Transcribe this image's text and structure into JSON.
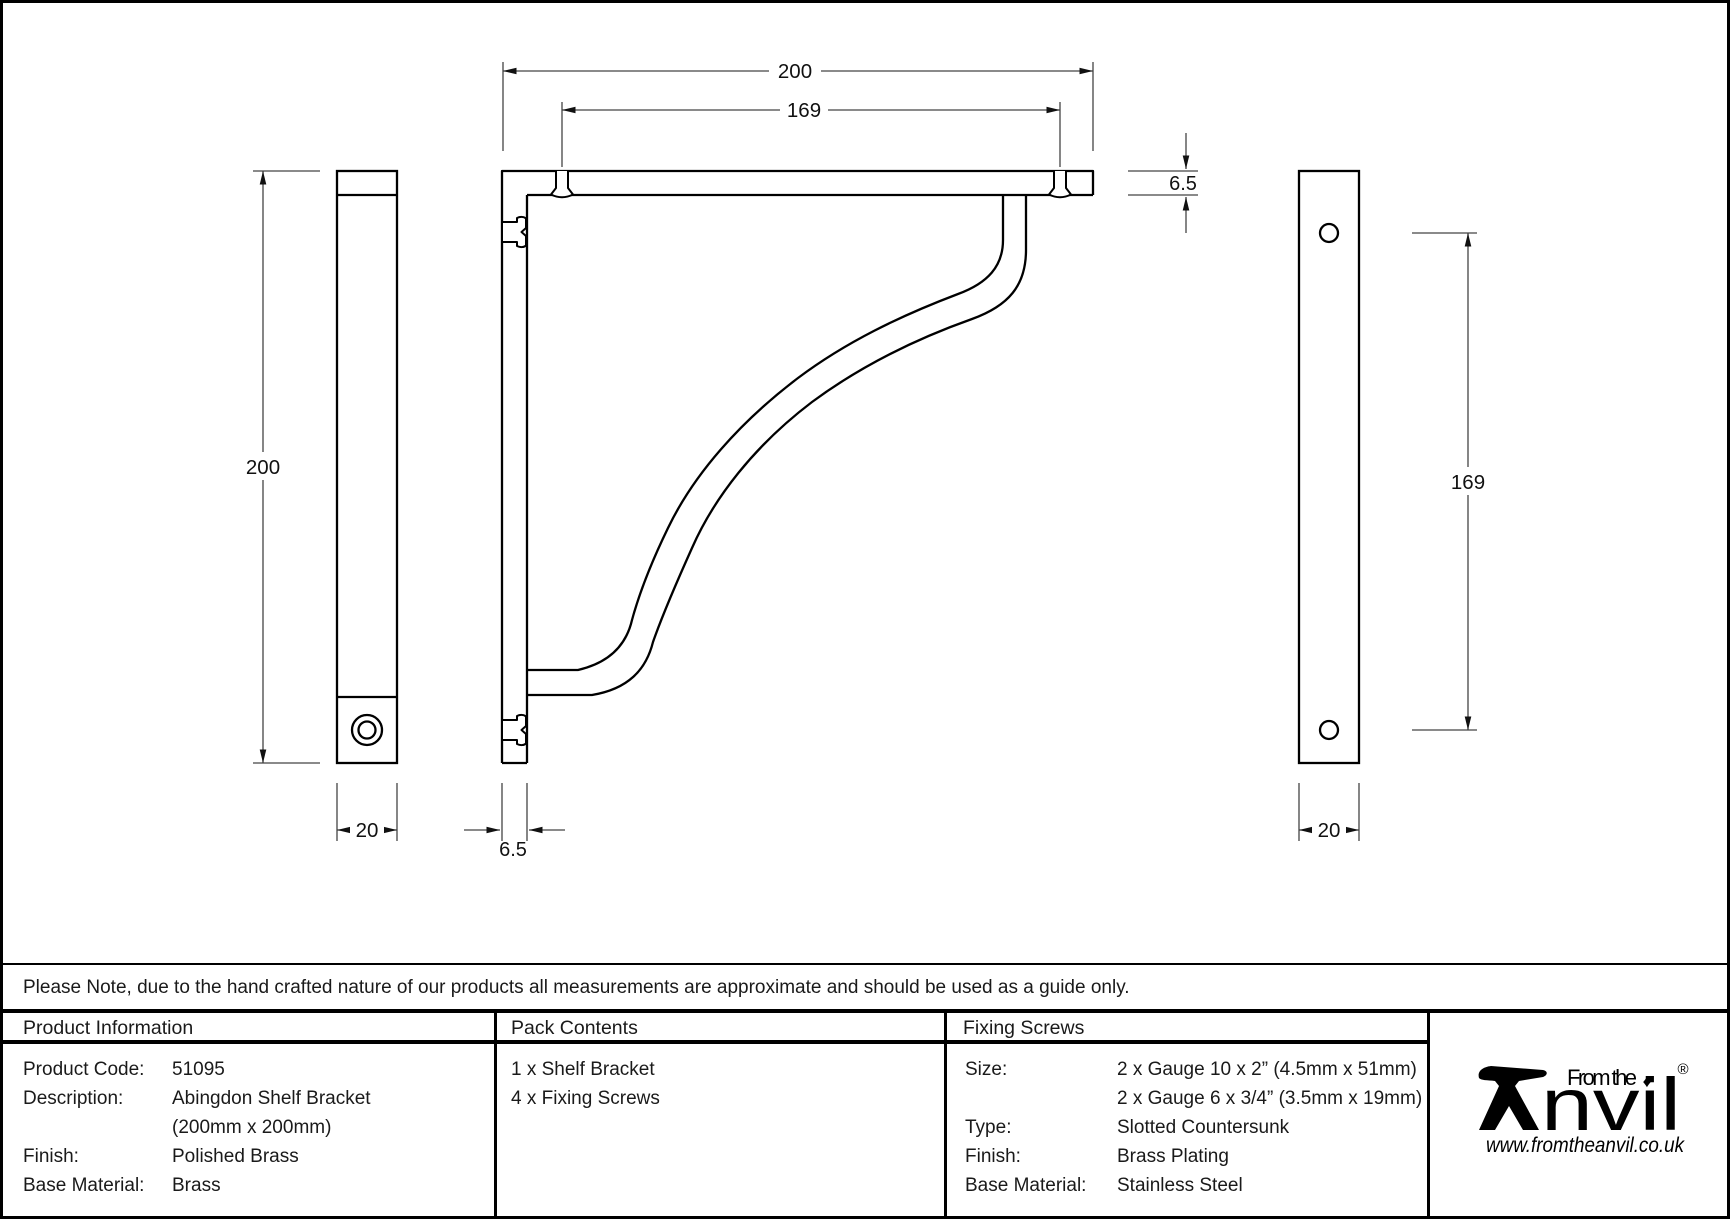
{
  "drawing": {
    "title": "Abingdon shelf bracket technical drawing",
    "dims": {
      "front_width": "200",
      "front_screw_spacing": "169",
      "arm_thickness": "6.5",
      "upright_thickness": "6.5",
      "side_height": "200",
      "side_width": "20",
      "back_hole_spacing": "169",
      "back_width": "20"
    }
  },
  "note": {
    "text": "Please Note, due to the hand crafted nature of our products all measurements are approximate and should be used as a guide only."
  },
  "table": {
    "product_information": {
      "title": "Product Information",
      "rows": [
        {
          "label": "Product Code:",
          "value": "51095"
        },
        {
          "label": "Description:",
          "value": "Abingdon Shelf Bracket"
        },
        {
          "label": "",
          "value": "(200mm x 200mm)"
        },
        {
          "label": "Finish:",
          "value": "Polished Brass"
        },
        {
          "label": "Base Material:",
          "value": "Brass"
        }
      ]
    },
    "pack_contents": {
      "title": "Pack Contents",
      "items": [
        "1 x Shelf Bracket",
        "4 x Fixing Screws"
      ]
    },
    "fixing_screws": {
      "title": "Fixing Screws",
      "rows": [
        {
          "label": "Size:",
          "value": "2 x Gauge 10 x 2” (4.5mm x 51mm)"
        },
        {
          "label": "",
          "value": "2 x Gauge 6 x 3/4” (3.5mm x 19mm)"
        },
        {
          "label": "Type:",
          "value": "Slotted Countersunk"
        },
        {
          "label": "Finish:",
          "value": "Brass Plating"
        },
        {
          "label": "Base Material:",
          "value": "Stainless Steel"
        }
      ]
    },
    "logo": {
      "tagline": "From the",
      "wordmark": "Anvil",
      "wordmark_rest": "nvil",
      "diamond": "♦",
      "registered": "®",
      "url": "www.fromtheanvil.co.uk",
      "color": "#000000"
    }
  }
}
